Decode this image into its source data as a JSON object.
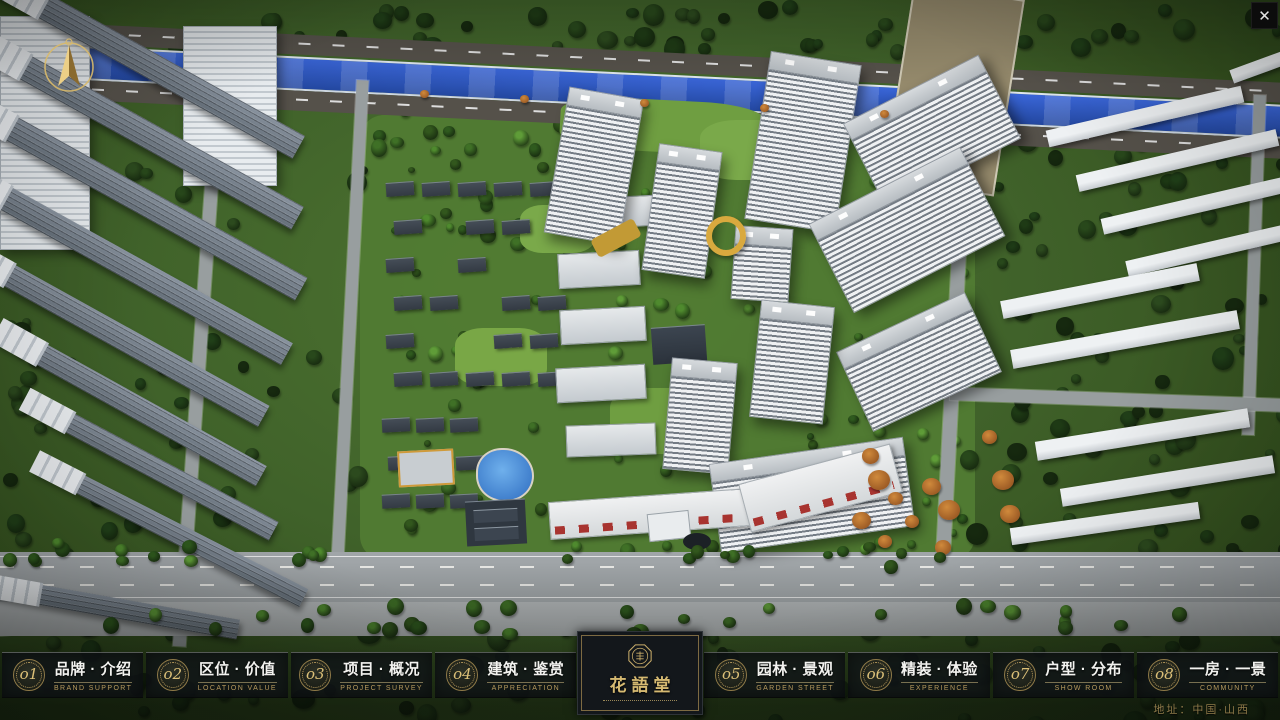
{
  "logo": {
    "title": "花語堂",
    "seal_icon": "octagonal-seal"
  },
  "nav": {
    "items": [
      {
        "num": "o1",
        "zh": "品牌 · 介绍",
        "en": "BRAND SUPPORT"
      },
      {
        "num": "o2",
        "zh": "区位 · 价值",
        "en": "LOCATION VALUE"
      },
      {
        "num": "o3",
        "zh": "项目 · 概况",
        "en": "PROJECT SURVEY"
      },
      {
        "num": "o4",
        "zh": "建筑 · 鉴赏",
        "en": "APPRECIATION"
      },
      {
        "num": "o5",
        "zh": "园林 · 景观",
        "en": "GARDEN STREET"
      },
      {
        "num": "o6",
        "zh": "精装 · 体验",
        "en": "EXPERIENCE"
      },
      {
        "num": "o7",
        "zh": "户型 · 分布",
        "en": "SHOW ROOM"
      },
      {
        "num": "o8",
        "zh": "一房 · 一景",
        "en": "COMMUNITY"
      }
    ]
  },
  "footer": {
    "address": "地址：中国·山西"
  },
  "controls": {
    "close_label": "✕"
  },
  "colors": {
    "accent_gold": "#c9a95e",
    "nav_bg": "rgba(16,20,24,0.80)",
    "nav_text": "#f2f2ef",
    "nav_en": "#b79a5e",
    "river_blue": "#2b54c4",
    "compass_gold": "#d8b96a"
  }
}
